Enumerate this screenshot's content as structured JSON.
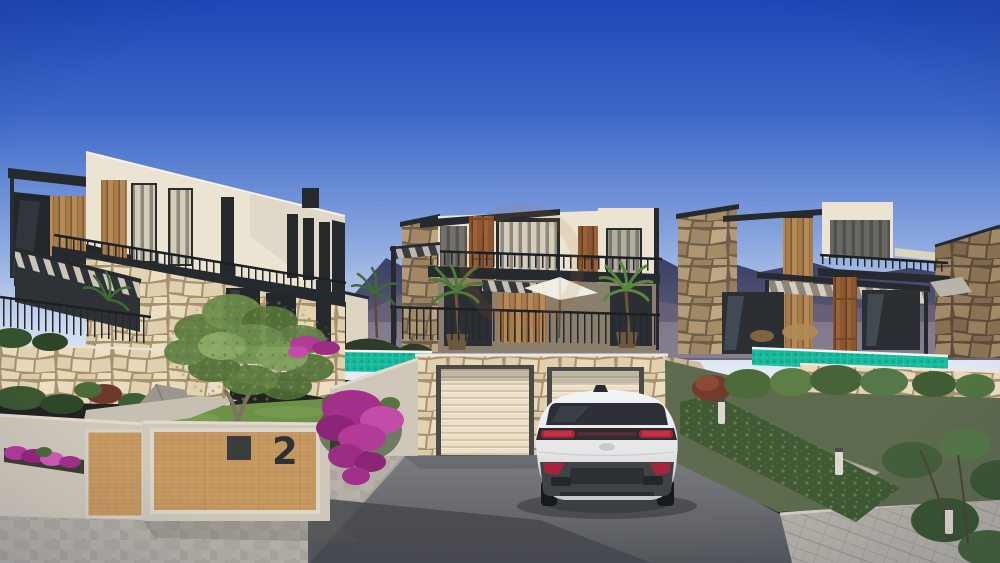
{
  "scene": {
    "description": "architectural render of three modern stone-and-white villas with garages, driveway and white SUV",
    "house_number": "2",
    "objects": [
      "villa-left",
      "villa-middle",
      "villa-right",
      "garage-block",
      "white-suv",
      "entrance-wall",
      "olive-tree",
      "bougainvillea",
      "pool-glass-fence",
      "driveway",
      "bollard-lights",
      "mountains"
    ]
  },
  "colors": {
    "sky-top": "#1c47b5",
    "sky-horizon": "#e7edf6",
    "mountain": "#3a4368",
    "villa-white": "#ece4d3",
    "villa-white-shade": "#dcd3c0",
    "frame-dark": "#26292d",
    "wood": "#a67c4c",
    "corten": "#8a5632",
    "stone-field": "#e5d6b9",
    "stone-joint": "#a8926e",
    "stone-brown": "#8a7356",
    "teal-fence": "#14b79a",
    "garage-door": "#eadfc8",
    "asphalt": "#6e7175",
    "asphalt-shadow": "#45484d",
    "paver": "#b6b2a9",
    "grass": "#6e9148",
    "foliage": "#5e7c40",
    "flower-magenta": "#b63a9c",
    "car-body": "#eceeef",
    "car-window": "#2c3036",
    "taillight-red": "#a32538",
    "bumper-dark": "#3f4347",
    "concrete": "#cfc8ba",
    "plywood": "#c79a63",
    "number-dark": "#2e3133",
    "watermark": "#b06a35"
  }
}
